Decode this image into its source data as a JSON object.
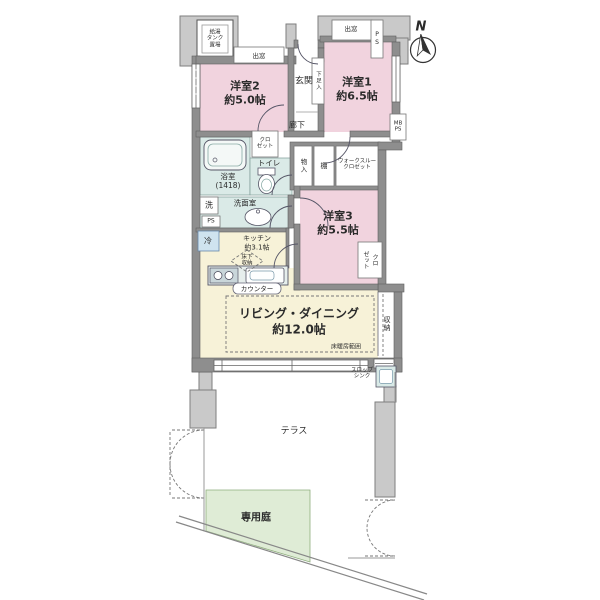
{
  "colors": {
    "room_pink": "#f1d3de",
    "ldk_yellow": "#f7f2d8",
    "wet_teal": "#daeae7",
    "garden_green": "#dfecd6",
    "wall_gray": "#8e8e8e",
    "common_gray": "#c9c9c9",
    "fridge_blue": "#cfe3ef"
  },
  "compass": {
    "north": "N"
  },
  "rooms": {
    "bedroom2": {
      "name": "洋室2",
      "size": "約5.0帖"
    },
    "bedroom1": {
      "name": "洋室1",
      "size": "約6.5帖"
    },
    "bedroom3": {
      "name": "洋室3",
      "size": "約5.5帖"
    },
    "living_dining": {
      "name": "リビング・ダイニング",
      "size": "約12.0帖"
    },
    "kitchen": {
      "name": "キッチン",
      "size": "約3.1帖"
    },
    "entrance": "玄関",
    "hallway": "廊下",
    "bathroom": {
      "name": "浴室",
      "size": "(1418)"
    },
    "toilet": "トイレ",
    "washroom": "洗面室",
    "terrace": "テラス",
    "private_garden": "専用庭"
  },
  "storage": {
    "closet_hall": {
      "line1": "クロ",
      "line2": "ゼット"
    },
    "closet_bedroom3": {
      "line1": "クロ",
      "line2": "ゼット"
    },
    "walk_through_closet": {
      "line1": "ウォークスルー",
      "line2": "クロゼット"
    },
    "storage_inner": "物入",
    "shelf": "棚",
    "shoe_box": "下足入",
    "storage_tall": "収納",
    "underfloor": {
      "line1": "床下",
      "line2": "収納"
    }
  },
  "equipment": {
    "bay_window_left": "出窓",
    "bay_window_right": "出窓",
    "water_tank": {
      "line1": "給湯",
      "line2": "タンク",
      "line3": "置場"
    },
    "washer": "洗",
    "fridge": "冷",
    "ps_small": "PS",
    "ps_shaft": "PS",
    "meter_box": {
      "line1": "MB",
      "line2": "PS"
    },
    "counter": "カウンター",
    "floor_heating": "床暖房範囲",
    "slop_sink": {
      "line1": "スロップ",
      "line2": "シンク"
    }
  }
}
